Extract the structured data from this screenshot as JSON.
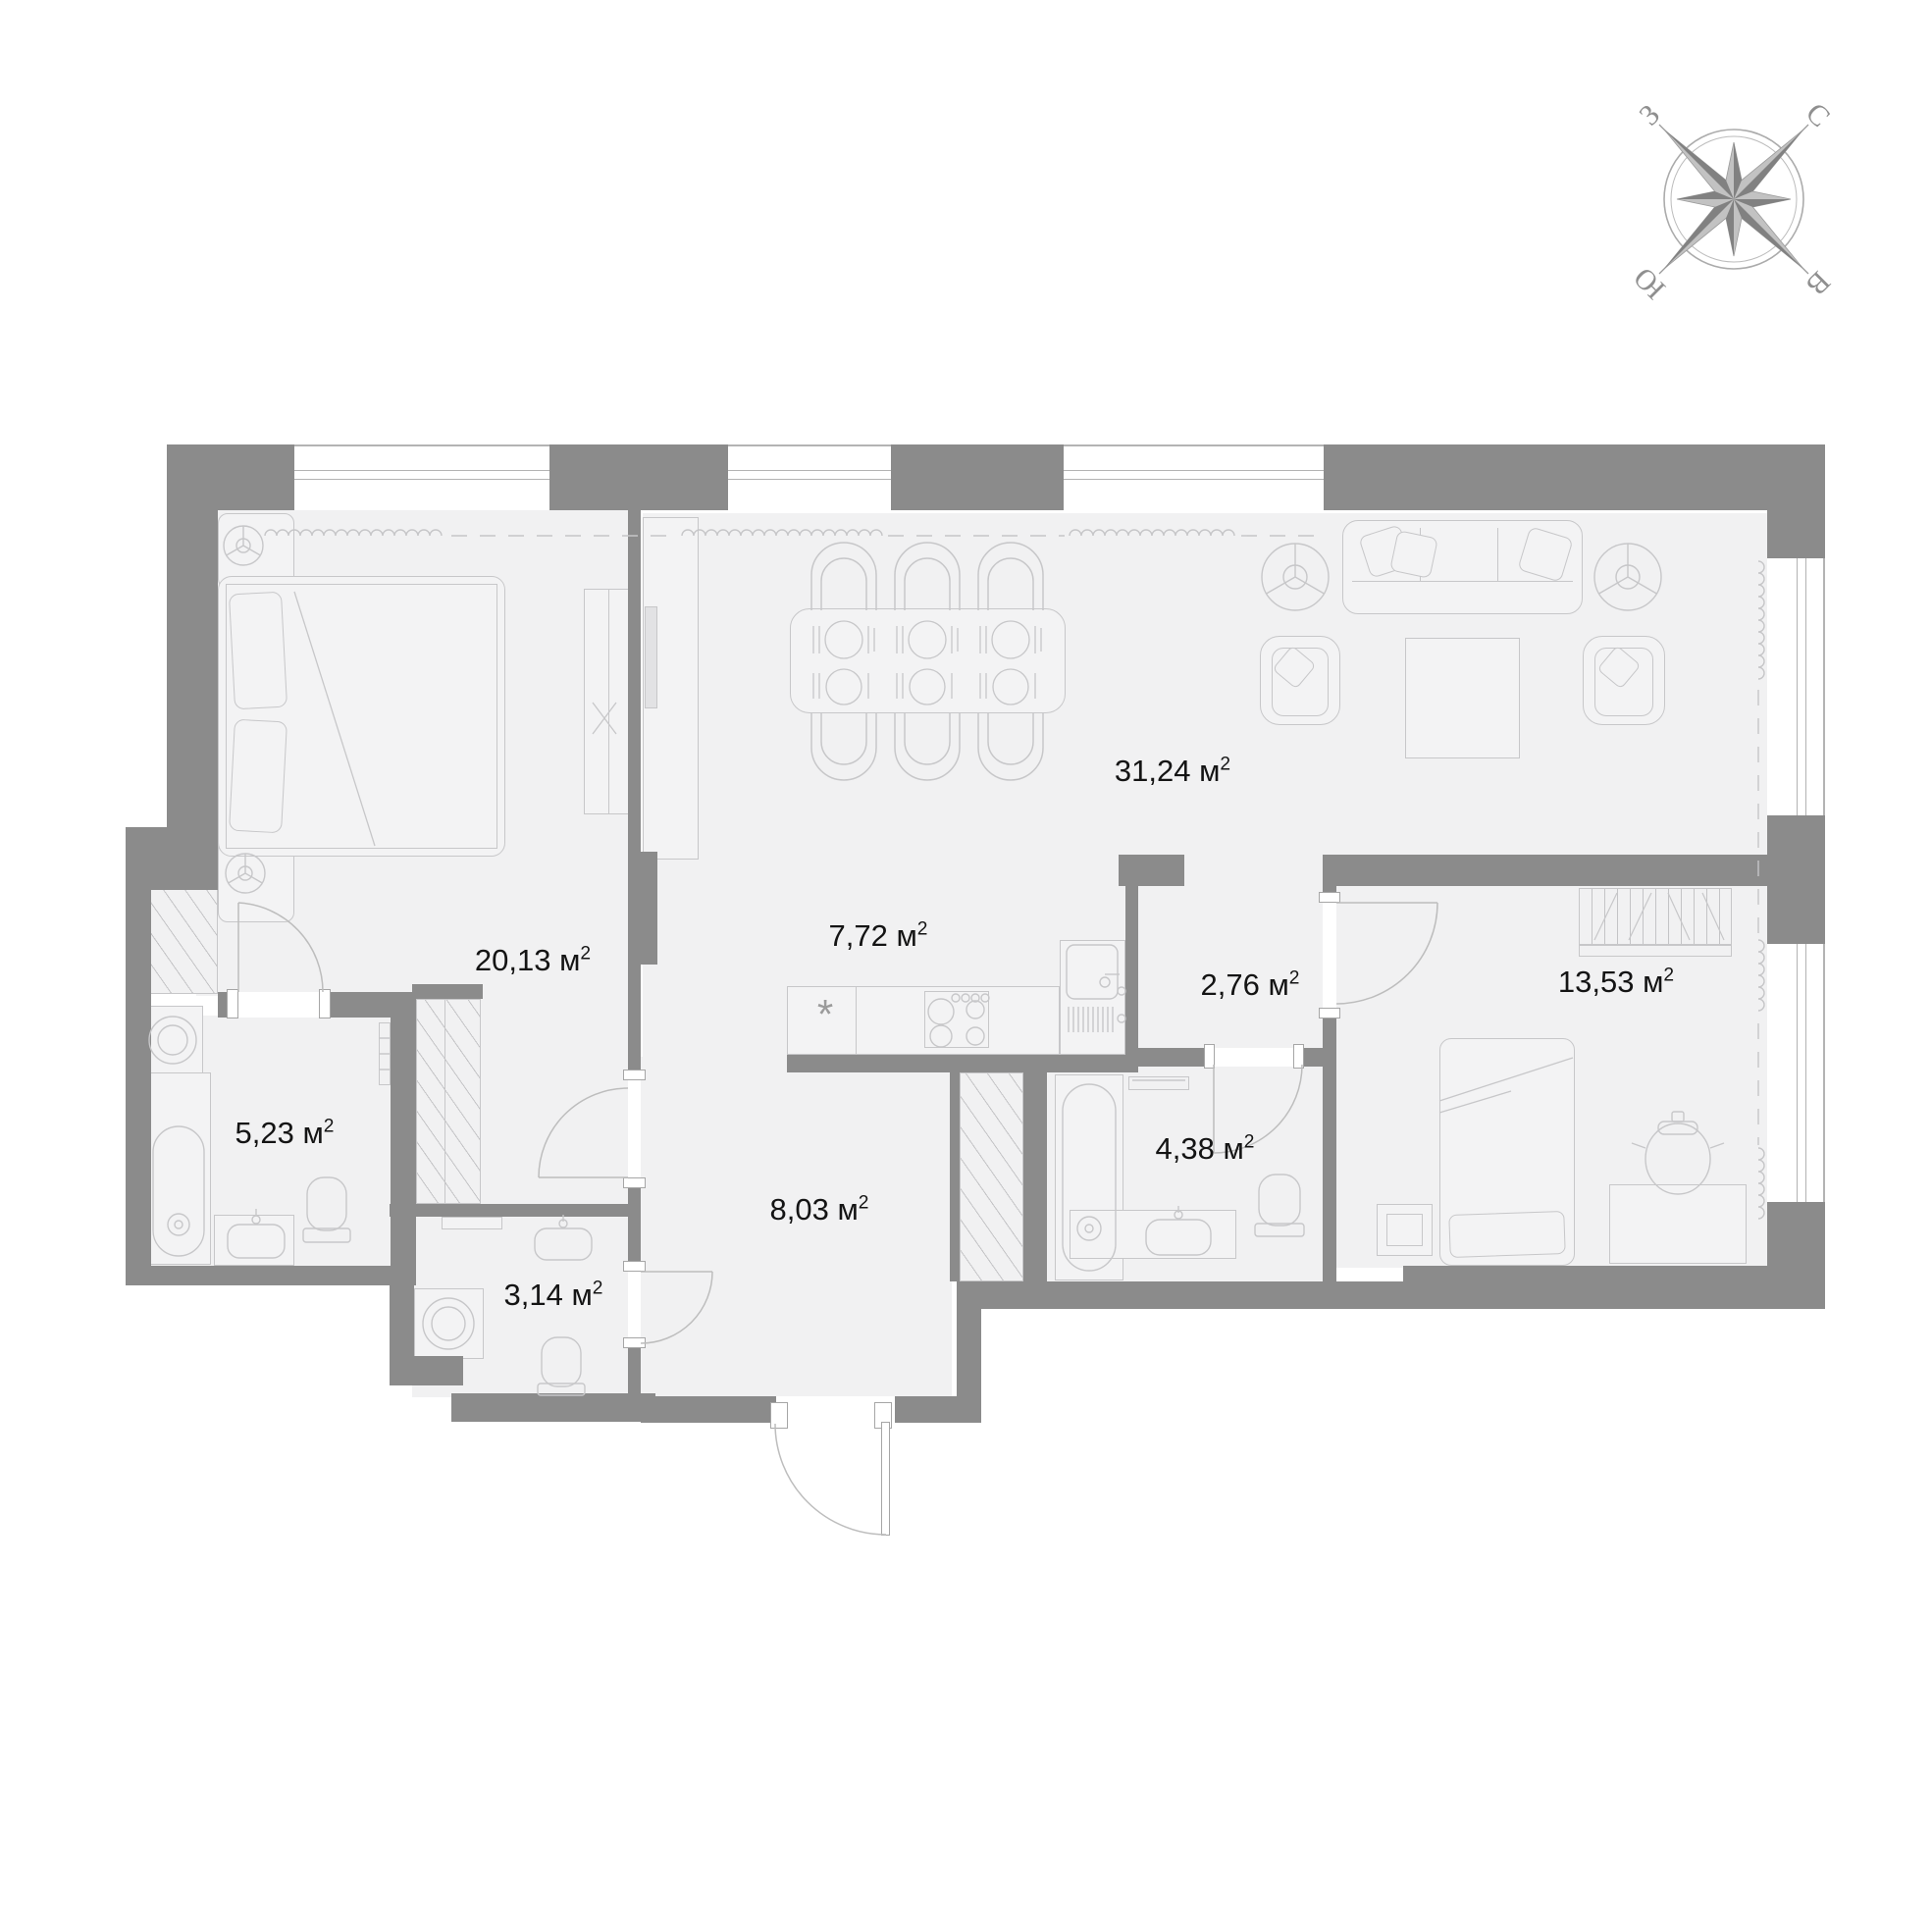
{
  "units": {
    "base": "м",
    "sup": "2"
  },
  "rooms": [
    {
      "key": "living-dining",
      "area": "31,24"
    },
    {
      "key": "bedroom-main",
      "area": "20,13"
    },
    {
      "key": "kitchen-zone",
      "area": "7,72"
    },
    {
      "key": "inner-hall",
      "area": "2,76"
    },
    {
      "key": "bedroom-second",
      "area": "13,53"
    },
    {
      "key": "ensuite-bathroom",
      "area": "5,23"
    },
    {
      "key": "bathroom-second",
      "area": "4,38"
    },
    {
      "key": "hallway",
      "area": "8,03"
    },
    {
      "key": "wc",
      "area": "3,14"
    }
  ],
  "compass": {
    "north": "С",
    "east": "В",
    "south": "Ю",
    "west": "З"
  },
  "kitchen": {
    "fridge_symbol": "*"
  },
  "colors": {
    "wall": "#8b8b8b",
    "room_fill": "#f1f1f2",
    "furniture_line": "#c7c7c9",
    "label": "#141414",
    "compass_gray": "#9a9a9a",
    "white": "#ffffff"
  }
}
